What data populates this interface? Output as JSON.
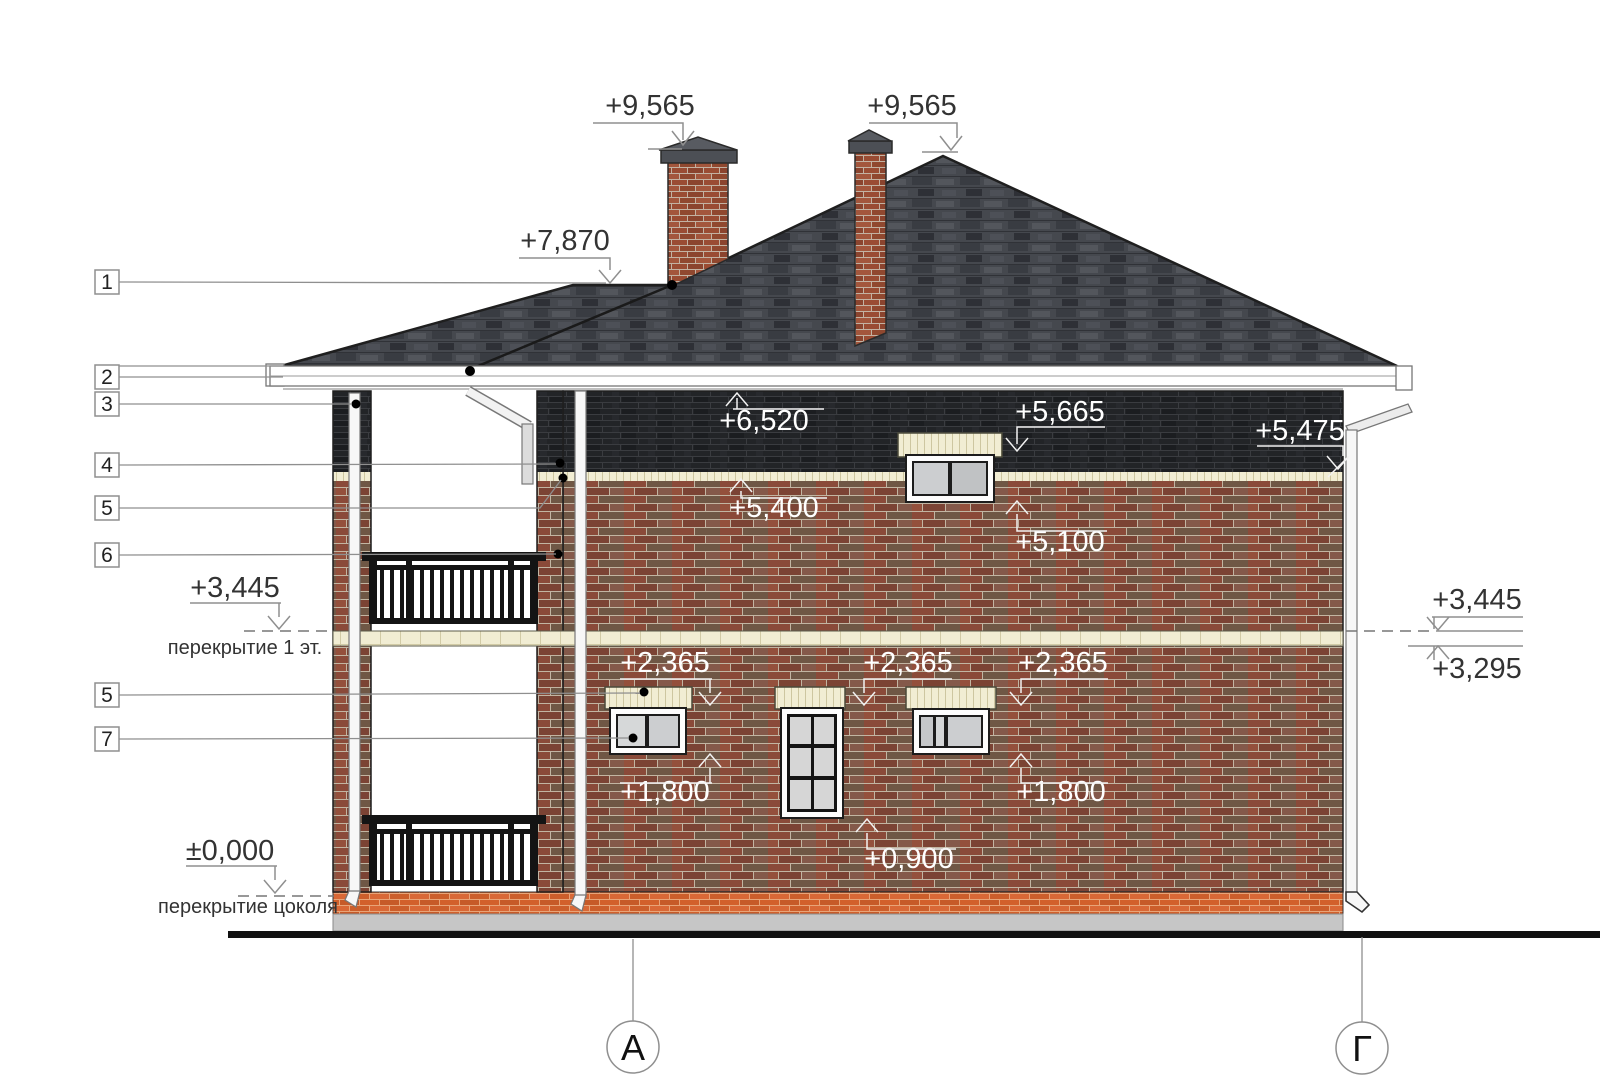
{
  "marks": {
    "chimney_left": "+9,565",
    "chimney_right": "+9,565",
    "porch_ridge": "+7,870",
    "wall_top": "+6,520",
    "upper_window_head": "+5,665",
    "band_top": "+5,475",
    "band_bottom": "+5,400",
    "upper_window_sill": "+5,100",
    "floor_left": "+3,445",
    "floor_right": "+3,445",
    "floor_right_bottom": "+3,295",
    "lower_head_left": "+2,365",
    "lower_head_mid": "+2,365",
    "lower_head_right": "+2,365",
    "lower_sill_left": "+1,800",
    "lower_sill_right": "+1,800",
    "door_sill": "+0,900",
    "zero": "±0,000"
  },
  "captions": {
    "floor1": "перекрытие 1 эт.",
    "plinth": "перекрытие цоколя"
  },
  "callouts": [
    {
      "label": "1"
    },
    {
      "label": "2"
    },
    {
      "label": "3"
    },
    {
      "label": "4"
    },
    {
      "label": "5"
    },
    {
      "label": "6"
    },
    {
      "label": "5"
    },
    {
      "label": "7"
    }
  ],
  "axes": {
    "left": "А",
    "right": "Г"
  },
  "colors": {
    "roof": "#45484e",
    "brick_wall": "#8a4a39",
    "dark_band": "#222427",
    "cream_band": "#f1edd3",
    "plinth": "#d2602b",
    "foundation": "#c6c6c6",
    "glass": "#ccced0",
    "railing": "#141414",
    "annotation_dark": "#333333",
    "annotation_light": "#ffffff"
  }
}
